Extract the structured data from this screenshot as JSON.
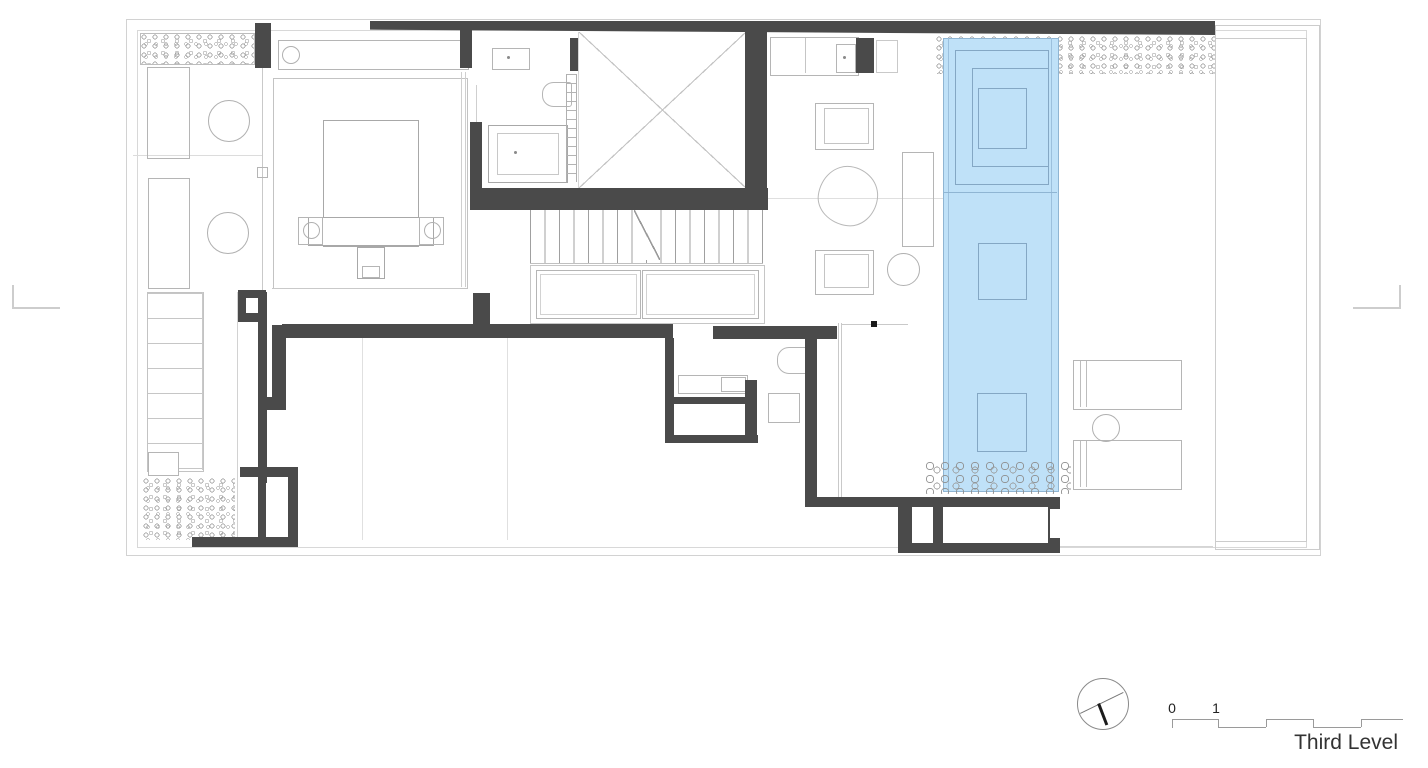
{
  "drawing": {
    "type": "architectural-floor-plan",
    "title": "Third Level"
  },
  "annotations": {
    "title": "Third Level",
    "scale_bar_labels": [
      "0",
      "1"
    ]
  },
  "colors": {
    "background": "#ffffff",
    "wall": "#4a4a4a",
    "pool_fill": "#bfe1f8",
    "pool_line": "#8fb5d3",
    "thin_line": "#c5c5c5",
    "medium_line": "#9a9a9a",
    "title_text": "#333333"
  },
  "features": [
    "site-boundary",
    "planting-bed",
    "terrace",
    "master-bedroom",
    "bed",
    "nightstands",
    "bathroom",
    "shower",
    "toilet",
    "bathtub",
    "void-skylight",
    "staircase",
    "closets",
    "living-area",
    "armchairs",
    "stone-coffee-table",
    "kitchenette",
    "lap-pool",
    "pebble-band",
    "lounge-chairs",
    "north-arrow",
    "scale-bar"
  ]
}
